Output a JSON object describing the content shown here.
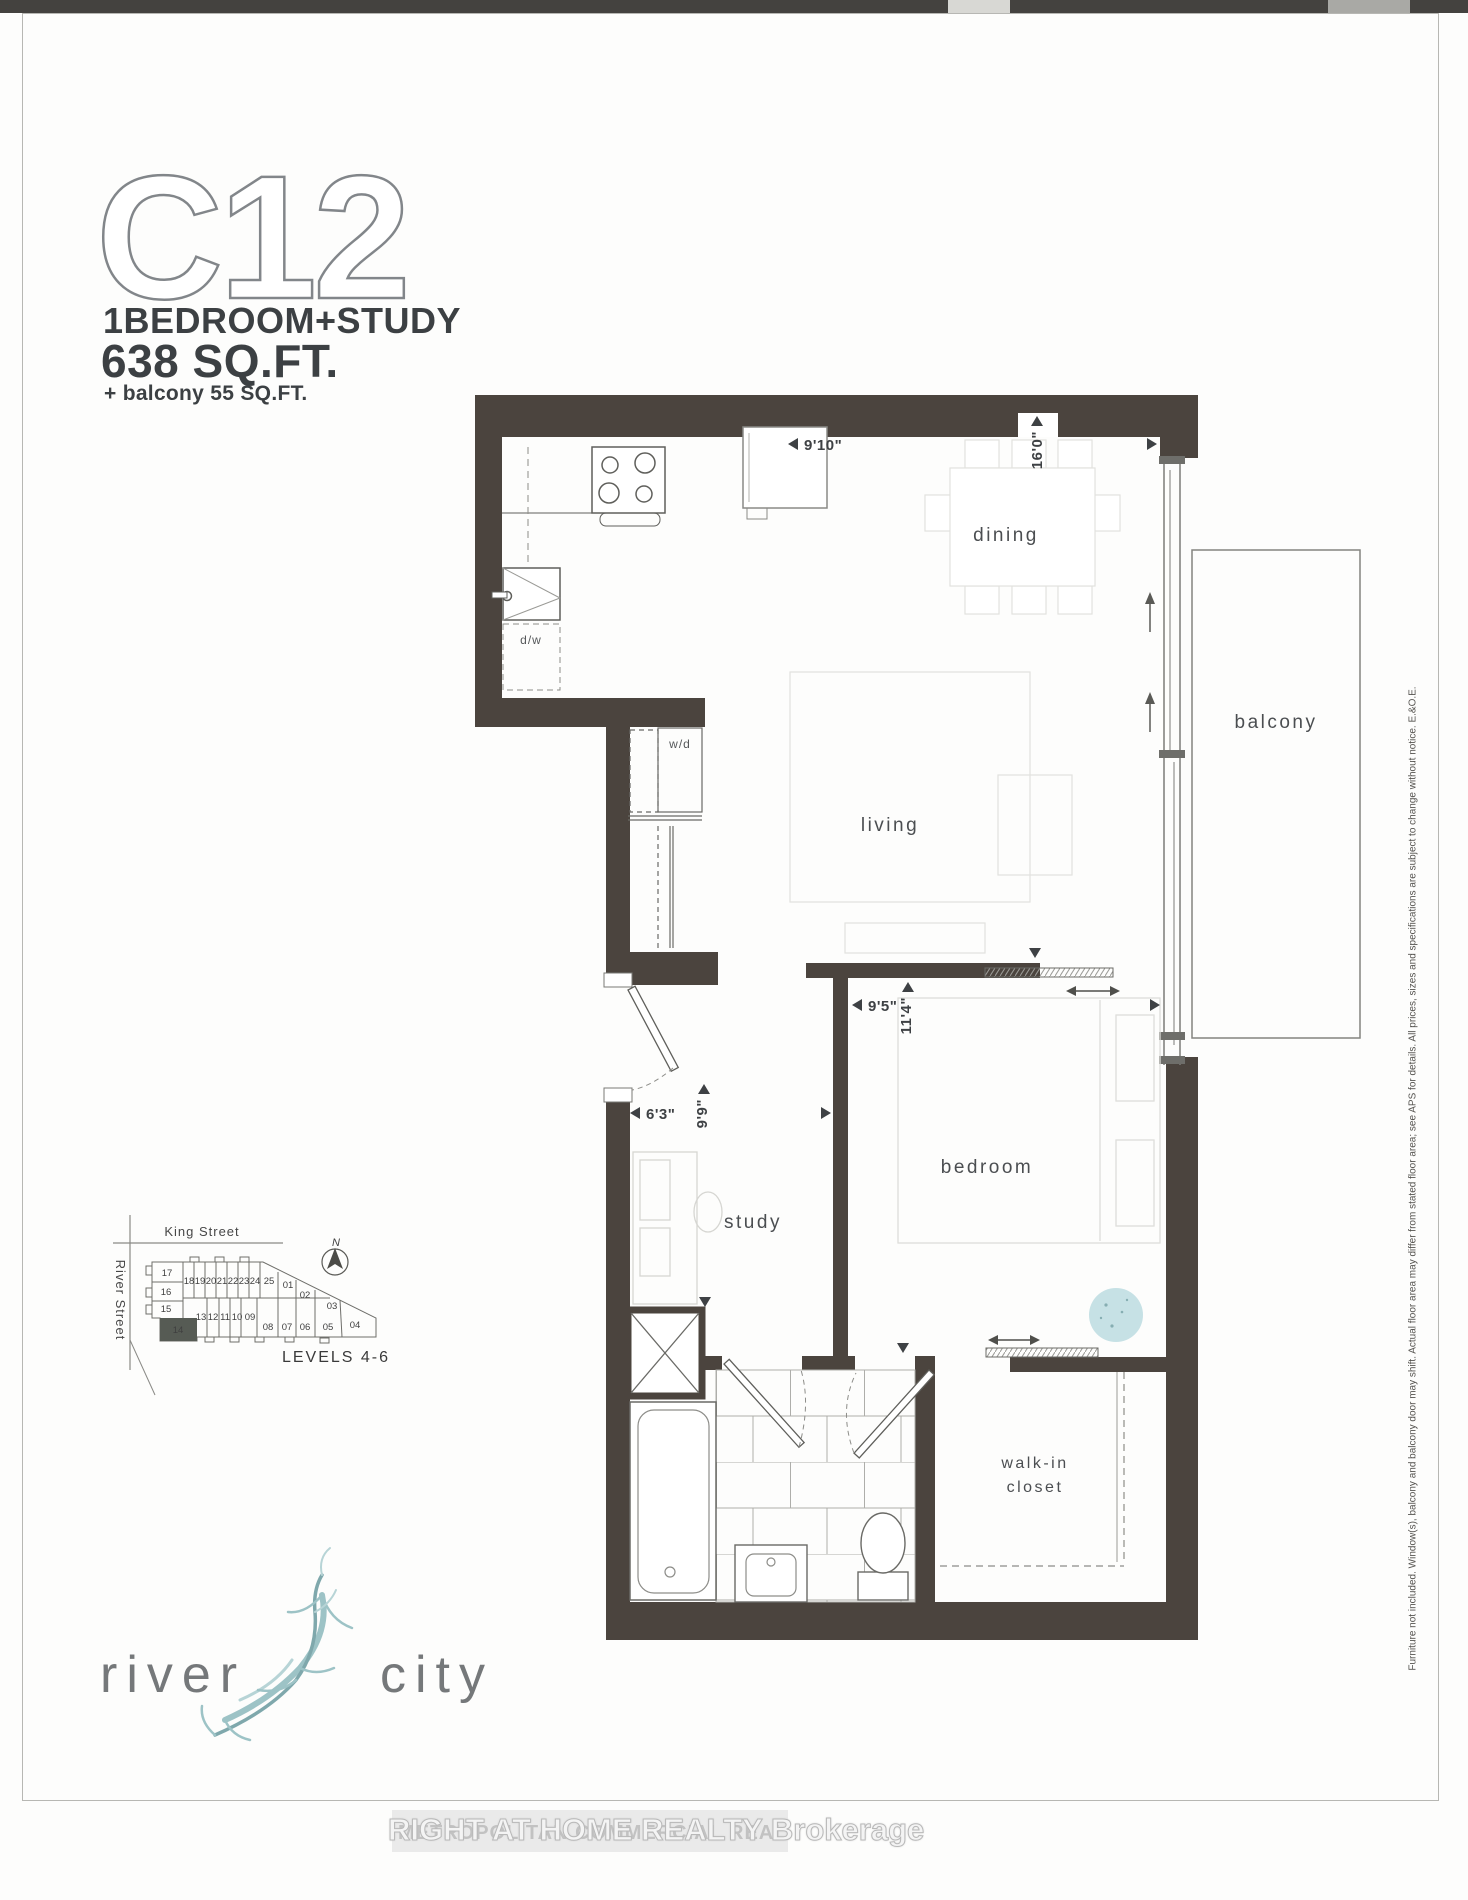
{
  "title": {
    "code": "C12",
    "type": "1BEDROOM+STUDY",
    "area": "638 SQ.FT.",
    "balcony": "+ balcony  55 SQ.FT."
  },
  "plan": {
    "labels": {
      "dining": "dining",
      "living": "living",
      "bedroom": "bedroom",
      "study": "study",
      "balcony": "balcony",
      "walkin1": "walk-in",
      "walkin2": "closet",
      "wd": "w/d",
      "dw": "d/w"
    },
    "dims": {
      "dining_w": "9'10\"",
      "dining_l": "16'0\"",
      "bedroom_w": "9'5\"",
      "bedroom_l": "11'4\"",
      "study_w": "6'3\"",
      "study_l": "9'9\""
    }
  },
  "keyplan": {
    "street_top": "King Street",
    "street_left": "River Street",
    "levels": "LEVELS 4-6",
    "north": "N",
    "highlight": "14",
    "left": [
      "17",
      "16",
      "15"
    ],
    "top": [
      "18",
      "19",
      "20",
      "21",
      "22",
      "23",
      "24",
      "25"
    ],
    "mid": [
      "13",
      "12",
      "11",
      "10",
      "09"
    ],
    "bottom": [
      "08",
      "07",
      "06",
      "05"
    ],
    "right": [
      "01",
      "02",
      "03",
      "04"
    ]
  },
  "logo": {
    "word1": "river",
    "word2": "city"
  },
  "watermark": {
    "primary": "RIGHT AT HOME REALTY Brokerage",
    "secondary": "METROPOLITAN COMMERCIAL REALTY"
  },
  "disclaimer": "Furniture not included. Window(s), balcony and balcony door may shift. Actual floor area may differ from stated floor area; see APS for details. All prices, sizes and specifications are subject to change without notice. E.&O.E.",
  "colors": {
    "wall": "#4b443e",
    "teal": "#9dc3c6",
    "stamp": "#bcdce0",
    "unit_highlight": "#565b54"
  }
}
